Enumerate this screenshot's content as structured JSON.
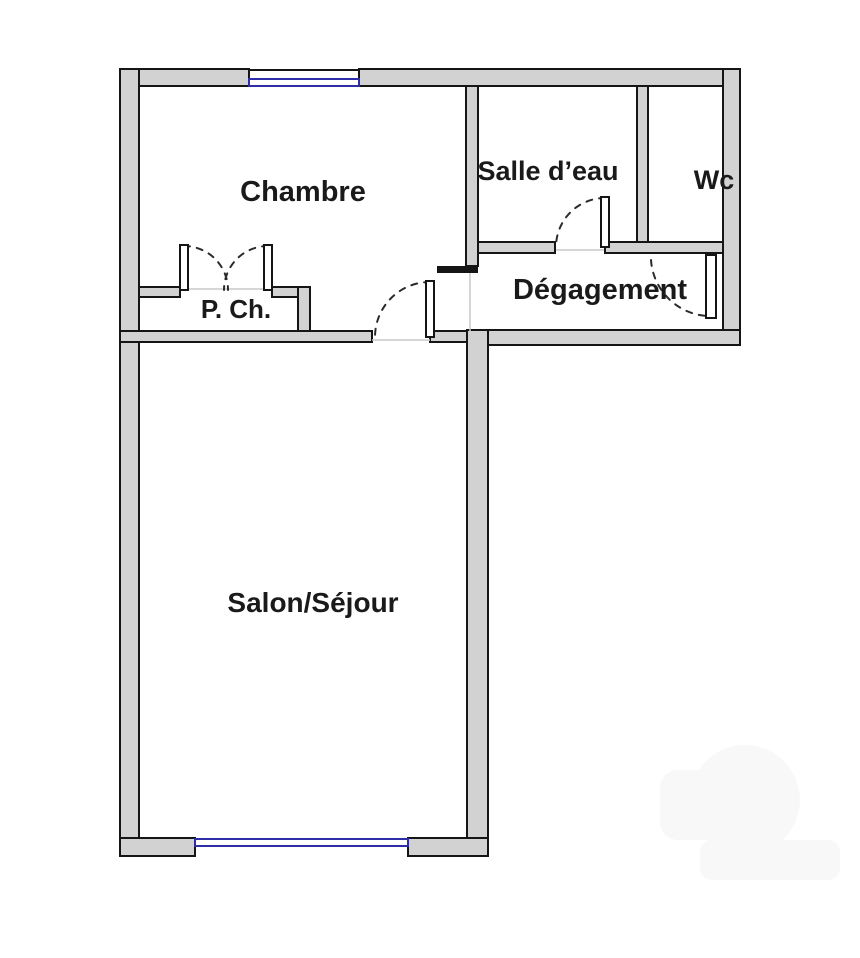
{
  "colors": {
    "wall_fill": "#d2d2d2",
    "wall_stroke": "#151515",
    "window_blue": "#2d2da8",
    "door_dash": "#2b2b2b",
    "threshold": "#c9c9c9",
    "label": "#1a1a1a",
    "background": "#ffffff"
  },
  "rooms": [
    {
      "key": "chambre",
      "label": "Chambre"
    },
    {
      "key": "salle_eau",
      "label": "Salle d’eau"
    },
    {
      "key": "wc",
      "label": "Wc"
    },
    {
      "key": "degagement",
      "label": "Dégagement"
    },
    {
      "key": "placard",
      "label": "P. Ch."
    },
    {
      "key": "salon",
      "label": "Salon/Séjour"
    }
  ]
}
